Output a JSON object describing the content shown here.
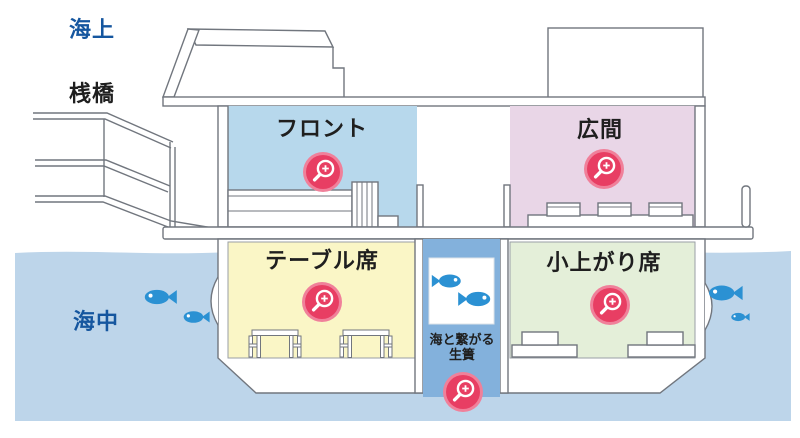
{
  "labels": {
    "above_sea": "海上",
    "pier": "桟橋",
    "undersea": "海中"
  },
  "rooms": [
    {
      "id": "front",
      "label": "フロント",
      "color": "#b7d8ec"
    },
    {
      "id": "hall",
      "label": "広間",
      "color": "#e9d6e7"
    },
    {
      "id": "table-seats",
      "label": "テーブル席",
      "color": "#faf6c6"
    },
    {
      "id": "tatami-seats",
      "label": "小上がり席",
      "color": "#e4efd9"
    }
  ],
  "tank": {
    "label_line1": "海と繋がる",
    "label_line2": "生簀",
    "column_color": "#83b1dc"
  },
  "icons": {
    "zoom": {
      "name": "magnifier-plus-icon",
      "color": "#e83e63",
      "count": 5
    },
    "fish": {
      "name": "fish-icon",
      "color": "#2b91d3",
      "count": 6
    }
  },
  "colors": {
    "water": "#bdd5ea",
    "outline": "#71767e",
    "zone_label_blue": "#15569f",
    "zone_label_black": "#1f1f1f"
  }
}
